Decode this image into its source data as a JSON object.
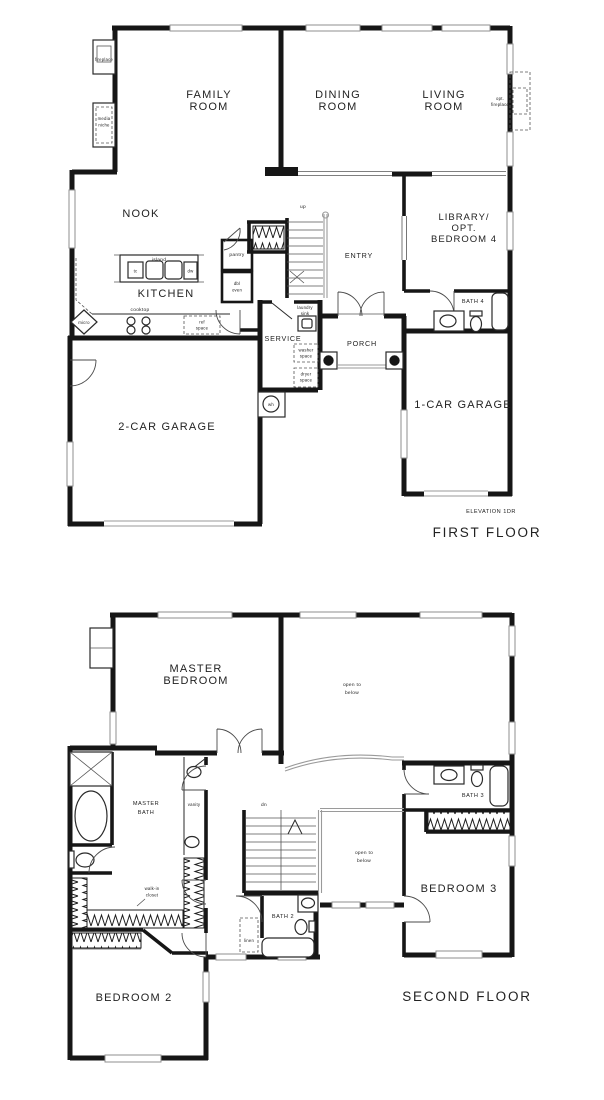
{
  "meta": {
    "drawing_type": "two-story house floor plan",
    "ink_color": "#1c1c1c",
    "window_gray": "#8f8f8f",
    "paper": "#ffffff"
  },
  "f1": {
    "title": "FIRST FLOOR",
    "elevation_note": "ELEVATION 1DR",
    "family": [
      "FAMILY",
      "ROOM"
    ],
    "dining": [
      "DINING",
      "ROOM"
    ],
    "living": [
      "LIVING",
      "ROOM"
    ],
    "nook": "NOOK",
    "kitchen": "KITCHEN",
    "entry": "ENTRY",
    "library": [
      "LIBRARY/",
      "OPT.",
      "BEDROOM 4"
    ],
    "bath4": "BATH 4",
    "service": "SERVICE",
    "porch": "PORCH",
    "garage2": "2-CAR GARAGE",
    "garage1": "1-CAR GARAGE",
    "fireplace": "fireplace",
    "media_niche": [
      "media",
      "niche"
    ],
    "opt_fireplace": [
      "opt.",
      "fireplace"
    ],
    "island": "island",
    "tc": "tc",
    "dw": "dw",
    "pantry": "pantry",
    "dbl_oven": [
      "dbl",
      "oven"
    ],
    "up": "up",
    "cooktop": "cooktop",
    "micro": "micro",
    "ref_space": [
      "ref",
      "space"
    ],
    "laundry_sink": [
      "laundry",
      "sink"
    ],
    "washer": [
      "washer",
      "space"
    ],
    "dryer": [
      "dryer",
      "space"
    ],
    "wh": "wh"
  },
  "f2": {
    "title": "SECOND FLOOR",
    "master_bedroom": [
      "MASTER",
      "BEDROOM"
    ],
    "master_bath": [
      "MASTER",
      "BATH"
    ],
    "bedroom2": "BEDROOM 2",
    "bedroom3": "BEDROOM 3",
    "bath2": "BATH 2",
    "bath3": "BATH 3",
    "open_below_top": [
      "open to",
      "below"
    ],
    "open_below_mid": [
      "open to",
      "below"
    ],
    "vanity": "vanity",
    "dn": "dn",
    "walkin": [
      "walk-in",
      "closet"
    ],
    "linen": "linen"
  }
}
